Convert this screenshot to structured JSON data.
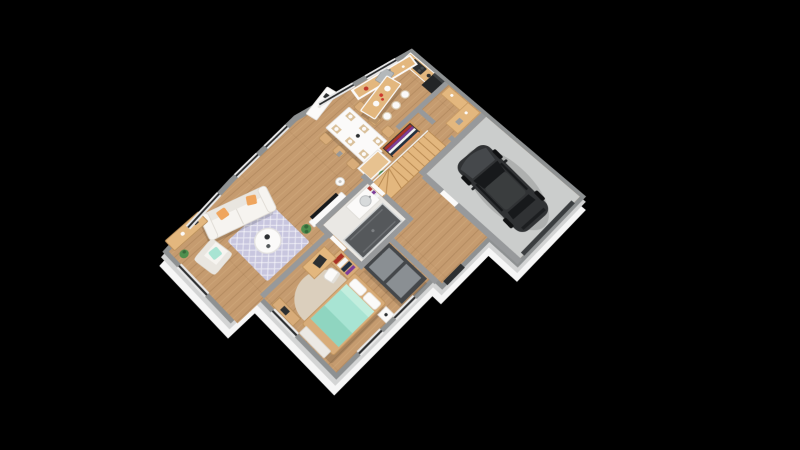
{
  "image": {
    "type": "3d-floor-plan-render",
    "view": "top-down isometric render rotated about 45 degrees on black background",
    "visible_text": "none"
  },
  "palette": {
    "bg": "#000000",
    "slab": "#f6f6f6",
    "slabEdge": "#d3d4d4",
    "wall": "#8e9192",
    "wallIn": "#97999b",
    "wood": "#c59b6f",
    "garageFloor": "#cbcdcc",
    "bathFloor": "#eae8e4",
    "white": "#fbfaf9",
    "counterWood": "#e3b77e",
    "stoolWood": "#d8ac79",
    "dark": "#2c2f31",
    "fridge": "#232527",
    "glass": "#2c2e30",
    "frame": "#e8e8e8",
    "rug": "#c8c6df",
    "roundRug": "#dbcfbd",
    "teal": "#a8e4d3",
    "tealDark": "#8fd5c0",
    "orange": "#efa55d",
    "car": "#303234",
    "carRoof": "#3a3d3e",
    "carGlass": "#17191b",
    "wheel": "#101112",
    "shower": "#55585b",
    "plant": "#4e8f4e",
    "plantDark": "#35683a",
    "wardrobe": "#44474a",
    "wardrobeDoor": "#8a8f93",
    "sofa": "#f6f4f0",
    "sofaShade": "#e9e6e0",
    "red": "#c0392b",
    "purple": "#7d3c98"
  },
  "rooms": [
    "kitchen",
    "pantry",
    "garage",
    "entrance-hall",
    "staircase",
    "dining-area",
    "living-room",
    "corridor",
    "bathroom",
    "bedroom"
  ],
  "furniture": {
    "kitchen": [
      "angled-counter-with-sink",
      "wall-counter-with-cooktop",
      "fridge",
      "island-with-three-stools"
    ],
    "pantry": [
      "wooden-counter",
      "wooden-cabinet"
    ],
    "garage": [
      "dark-suv-car",
      "garage-door",
      "service-door"
    ],
    "entrance-hall": [
      "open-wardrobe-with-clothes",
      "white-cabinet",
      "plant",
      "winder-staircase",
      "front-door"
    ],
    "dining-area": [
      "white-table",
      "six-wooden-chairs",
      "six-placemats",
      "sideboard"
    ],
    "living-room": [
      "white-sofa-with-orange-pillows",
      "lavender-trellis-rug",
      "round-coffee-table",
      "armchair-with-teal-pillow",
      "tv-on-console",
      "floor-lamp",
      "wooden-sideboard",
      "plants"
    ],
    "bathroom": [
      "vanity-with-sink",
      "walk-in-shower",
      "wall-decor"
    ],
    "bedroom": [
      "teal-double-bed",
      "round-beige-rug",
      "dark-wardrobe",
      "bookshelf",
      "desk-with-chair",
      "nightstand",
      "low-media-unit"
    ]
  }
}
